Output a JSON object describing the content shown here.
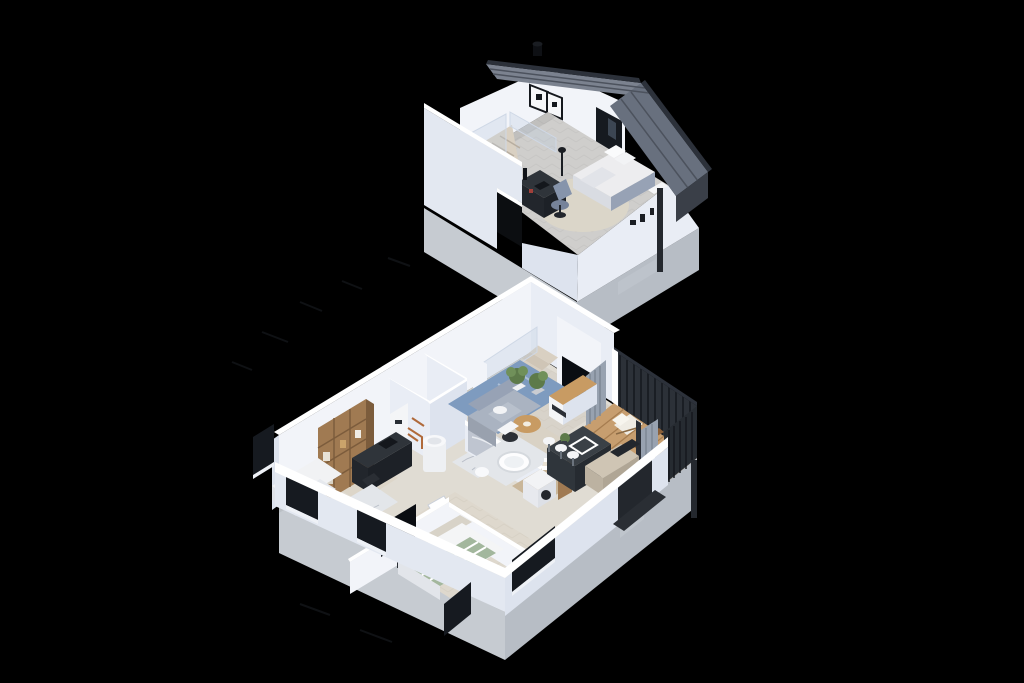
{
  "meta": {
    "description": "Axonometric cutaway 3D dollhouse rendering of a two-storey house, two separated level views on a black background",
    "view": "isometric dollhouse render",
    "levels_shown": 2
  },
  "colors": {
    "bg": "#000000",
    "wallTop": "#ffffff",
    "wallLight": "#f2f4f9",
    "wallMid": "#e9edf5",
    "wallShade": "#dde3ee",
    "wallOuter": "#e3e8f1",
    "concreteLight": "#c6cbd1",
    "concreteDark": "#b7bdc5",
    "plate": "#e0dcd3",
    "floorLiving": "#d8d3ca",
    "floorGray": "#cfcecc",
    "roofLight": "#7b828f",
    "roofMid": "#68707e",
    "roofDark": "#3a3f48",
    "roofTrim": "#2c313a",
    "glazing": "#161a20",
    "fenceDark": "#2c3138",
    "fenceLine": "#15181d",
    "deck": "#c79e6f",
    "deckLine": "#a57c4f",
    "woodShelf": "#a07a52",
    "woodDark": "#7c5c3c",
    "woodWarm": "#c89b63",
    "rugBlue": "#7e9bbf",
    "rugCream": "#dbd6c9",
    "marble": "#e3e6ea",
    "marbleVein": "#b9bec8",
    "sofa": "#aab3c1",
    "sofaDark": "#97a2b5",
    "darkFurn": "#2f343a",
    "darkerFurn": "#22262c",
    "green": "#5d7a4a",
    "greenLight": "#70905a",
    "copper": "#b06a3a",
    "bedGreen": "#a3b79d",
    "whiteFurn": "#f4f5f7",
    "curtain": "#98a2b0",
    "graphite": "#3a4046",
    "beige": "#cfc5b4",
    "stairs": "#d9d0c2",
    "stairsAlt": "#cfc5b6",
    "glassFill": "rgba(190,205,225,0.32)",
    "glassEdge": "#cfd8e6",
    "tvBlack": "#0a0d12",
    "matDark": "#23272d",
    "downspout": "#24282e"
  },
  "floors": [
    {
      "id": "upper",
      "name": "attic level",
      "rooms": [
        {
          "name": "attic bedroom studio",
          "furniture": [
            "standing-seam metal roof",
            "roof vent",
            "gable window with light strip",
            "two wall picture frames",
            "glass stair balustrade",
            "staircase",
            "dark desk with lamp and laptop",
            "swivel chair",
            "round cream rug",
            "double bed with white duvet and grey upholstery",
            "herringbone carpet floor",
            "downspout pipe",
            "concrete base"
          ]
        }
      ]
    },
    {
      "id": "ground",
      "name": "ground floor",
      "rooms": [
        {
          "name": "living room",
          "furniture": [
            "staircase with glass rail",
            "blue patterned rug",
            "grey corner sofa",
            "round wooden coffee table",
            "white side table",
            "potted plants",
            "tv on white pillar",
            "media sideboard",
            "grey curtains"
          ]
        },
        {
          "name": "kitchen",
          "furniture": [
            "graphite island with cooktop",
            "three white bar stools",
            "beige counter",
            "dark appliance block",
            "small plant"
          ]
        },
        {
          "name": "office guest room",
          "furniture": [
            "wooden bookshelf",
            "dark desk",
            "office chair",
            "marble rug",
            "single bed",
            "window"
          ]
        },
        {
          "name": "utility room",
          "furniture": [
            "wall boiler with copper pipes",
            "water heater cylinder"
          ]
        },
        {
          "name": "bathroom",
          "furniture": [
            "marble floor",
            "white tub",
            "marble wall accent"
          ]
        },
        {
          "name": "laundry",
          "furniture": [
            "washing machine",
            "towel stack",
            "wooden shelf"
          ]
        },
        {
          "name": "bedroom",
          "furniture": [
            "double bed with green striped duvet",
            "wall tv",
            "white console",
            "windows"
          ]
        },
        {
          "name": "hallway",
          "furniture": [
            "marble runner",
            "white doors"
          ]
        },
        {
          "name": "balcony terrace",
          "furniture": [
            "wood deck",
            "dark slat railing",
            "sun lounger",
            "bistro table and chairs",
            "grey curtains",
            "downspout pipe"
          ]
        }
      ]
    }
  ]
}
